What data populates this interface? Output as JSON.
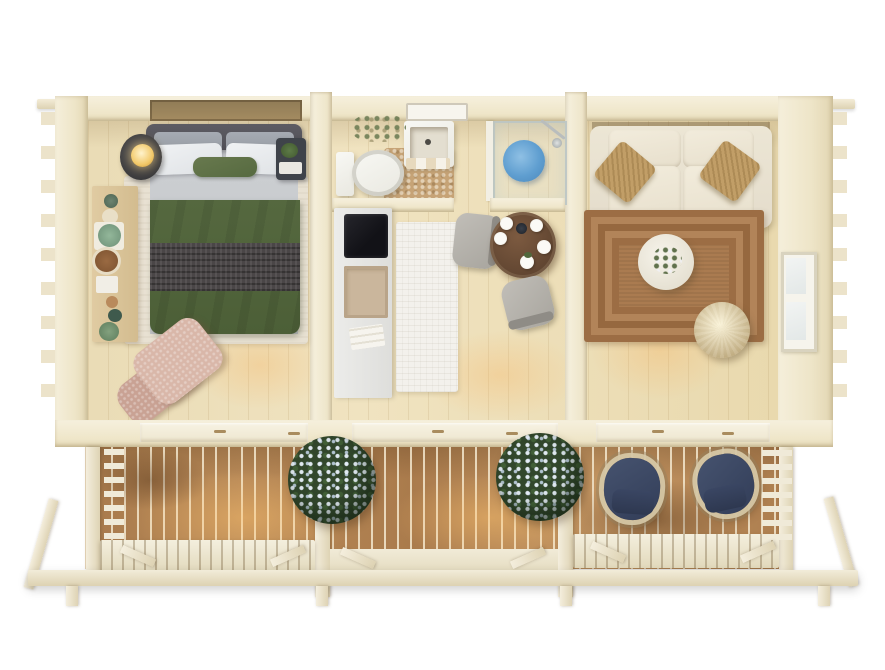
{
  "scene": {
    "title": "Top-down 3D render of a wooden garden cabin with three rooms and a front terrace",
    "view": "top-down bird's eye",
    "background": "#ffffff"
  },
  "palette": {
    "wall_wood": "#f1e9d2",
    "floor_wood": "#ecddb8",
    "deck_wood": "#b5875a",
    "railing_cream": "#efe9d6",
    "duvet_green": "#50633c",
    "throw_grey": "#4a4647",
    "armchair_pink": "#d7b5a7",
    "sofa_cream": "#e9e2d1",
    "cushion_tan": "#c19e67",
    "jute_rug_brown": "#aa7b50",
    "dining_table_walnut": "#6b4c36",
    "shower_mat_blue": "#5f9ed0",
    "deck_chair_navy": "#3e4c6d",
    "flower_white": "#e6eef8",
    "leaf_green": "#32472c",
    "lamp_glow": "#ffe9b0"
  },
  "building": {
    "label": "Log cabin shell with protruding corner joints",
    "rooms": {
      "bedroom": {
        "label": "Bedroom",
        "bed": "Double bed with grey headboard, white pillows, green accent pillow, green duvet and dark knit throw",
        "rug": "Light area rug under bed",
        "nightstand_left": "Round nightstand with glowing lamp",
        "nightstand_right": "Nightstand with plant and books",
        "shelf": "Wall shelf with plants, bowls and candles",
        "armchair": "Pink boucle lounge chair"
      },
      "bathroom": {
        "label": "Bathroom",
        "toilet": "White toilet",
        "bath_mat": "Beige pebble bath mat",
        "vanity": "Washbasin vanity with towels",
        "mirror": "Mirror light bar",
        "plants": "Dried plant arrangement",
        "shower": "Glass shower enclosure with blue round mat"
      },
      "kitchen_dining": {
        "label": "Kitchenette and dining corner",
        "counter": "White counter with black hob and sink",
        "towel": "Kitchen towel",
        "rug": "White ribbed runner rug",
        "dining_table": "Round walnut table set with plates and dark kettle",
        "chair_top": "Grey upholstered chair",
        "chair_bottom": "Grey upholstered chair"
      },
      "living_room": {
        "label": "Living room",
        "sofa": "Cream three-seat sofa with two tan woven cushions",
        "rug": "Braided jute rug",
        "coffee_table": "Round white coffee table with flower arrangement",
        "pouf": "Woven rattan pouf",
        "window": "Side wall window"
      },
      "deck": {
        "label": "Front terrace",
        "planter_left": "Flowering shrub planter",
        "planter_right": "Flowering shrub planter",
        "chair_left": "Navy wicker armchair",
        "chair_right": "Navy wicker armchair",
        "railing": "Cream slatted railing with open entry in the middle",
        "beam": "Front foundation beam"
      }
    }
  }
}
